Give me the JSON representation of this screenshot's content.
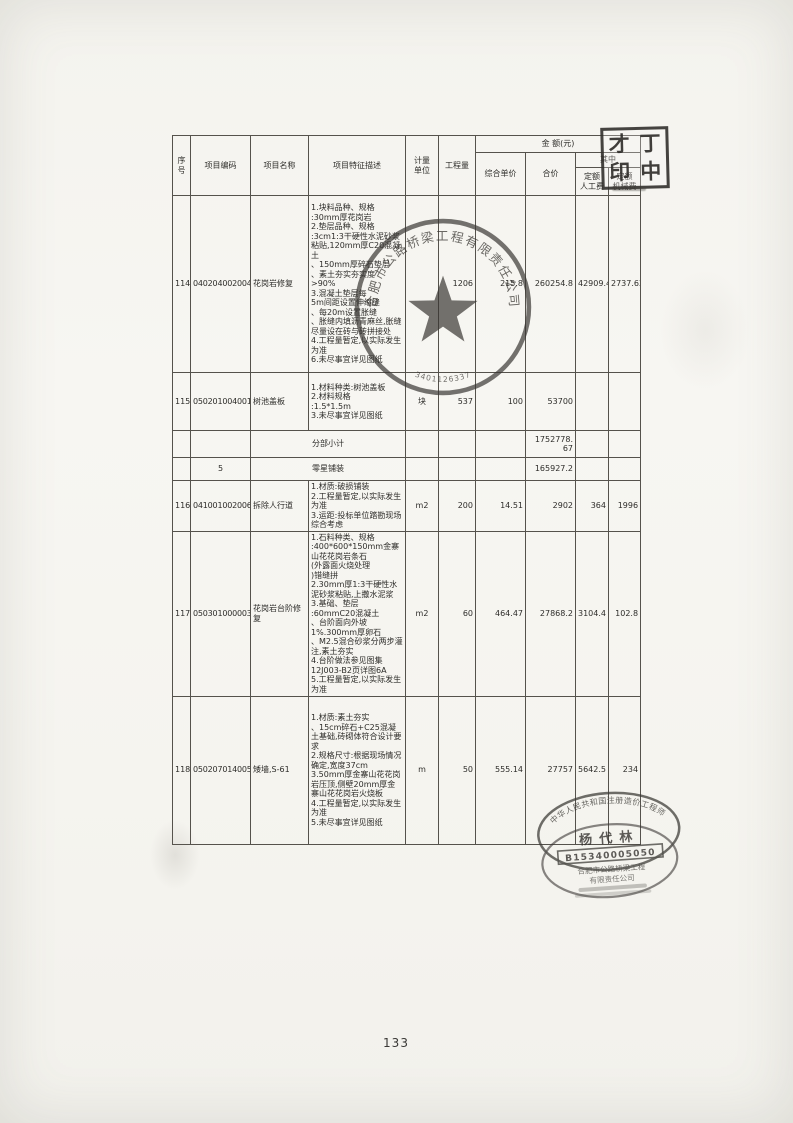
{
  "page": {
    "number": "133"
  },
  "table": {
    "header": {
      "no": "序\n号",
      "code": "项目编码",
      "name": "项目名称",
      "feature": "项目特征描述",
      "unit": "计量\n单位",
      "qty": "工程量",
      "amount": "金  额(元)",
      "unit_price": "综合单价",
      "total": "合价",
      "among": "其中",
      "labor": "定额\n人工费",
      "machine": "定额\n机械费"
    },
    "rows": [
      {
        "no": "114",
        "code": "040204002004",
        "name": "花岗岩修复",
        "desc": "1.块料品种、规格\n:30mm厚花岗岩\n2.垫层品种、规格\n:3cm1:3干硬性水泥砂浆粘贴,120mm厚C20混凝土\n、150mm厚碎石垫层\n、素土夯实夯实度\n>90%\n3.混凝土垫层每\n5m间距设置伸缩缝\n、每20m设置胀缝\n、胀缝内填沥青麻丝,胀缝尽量设在砖与砖拼接处\n4.工程量暂定,以实际发生为准\n6.未尽事宜详见图纸",
        "unit": "",
        "qty": "1206",
        "price": "215.8",
        "total": "260254.8",
        "labor": "42909.48",
        "machine": "2737.62"
      },
      {
        "no": "115",
        "code": "050201004001",
        "name": "树池盖板",
        "desc": "1.材料种类:树池盖板\n2.材料规格\n:1.5*1.5m\n3.未尽事宜详见图纸",
        "unit": "块",
        "qty": "537",
        "price": "100",
        "total": "53700",
        "labor": "",
        "machine": ""
      },
      {
        "no": "116",
        "code": "041001002006",
        "name": "拆除人行道",
        "desc": "1.材质:破损铺装\n2.工程量暂定,以实际发生为准\n3.运距:投标单位踏勘现场综合考虑",
        "unit": "m2",
        "qty": "200",
        "price": "14.51",
        "total": "2902",
        "labor": "364",
        "machine": "1996"
      },
      {
        "no": "117",
        "code": "050301000003",
        "name": "花岗岩台阶修复",
        "desc": "1.石料种类、规格\n:400*600*150mm金寨山花花岗岩条石\n(外露面火烧处理\n)错缝拼\n2.30mm厚1:3干硬性水泥砂浆粘贴,上撒水泥浆\n3.基础、垫层\n:60mmC20混凝土\n、台阶面向外坡\n1%.300mm厚卵石\n、M2.5混合砂浆分两步灌注,素土夯实\n4.台阶做法参见图集12J003-B2页详图6A\n5.工程量暂定,以实际发生为准",
        "unit": "m2",
        "qty": "60",
        "price": "464.47",
        "total": "27868.2",
        "labor": "3104.4",
        "machine": "102.8"
      },
      {
        "no": "118",
        "code": "050207014005",
        "name": "矮墙,S-61",
        "desc": "1.材质:素土夯实\n、15cm碎石+C25混凝土基础,砖砌体符合设计要求\n2.规格尺寸:根据现场情况确定,宽度37cm\n3.50mm厚金寨山花花岗岩压顶,侧壁20mm厚金寨山花花岗岩火烧板\n4.工程量暂定,以实际发生为准\n5.未尽事宜详见图纸",
        "unit": "m",
        "qty": "50",
        "price": "555.14",
        "total": "27757",
        "labor": "5642.5",
        "machine": "234"
      }
    ],
    "subtotal": {
      "label": "分部小计",
      "total": "1752778.\n67"
    },
    "section": {
      "code": "5",
      "label": "零星铺装",
      "total": "165927.2"
    }
  },
  "stamps": {
    "square_seal": {
      "chars": [
        "才",
        "丁",
        "印",
        "中"
      ]
    },
    "round_seal": {
      "company": "合肥市公路桥梁工程有限责任公司",
      "number": "3401126337"
    },
    "engineer_seal": {
      "title_arc": "中华人民共和国注册造价工程师",
      "name": "杨代林",
      "cert_no": "B15340005050",
      "company_line1": "合肥市公路桥梁工程",
      "company_line2": "有限责任公司"
    }
  }
}
